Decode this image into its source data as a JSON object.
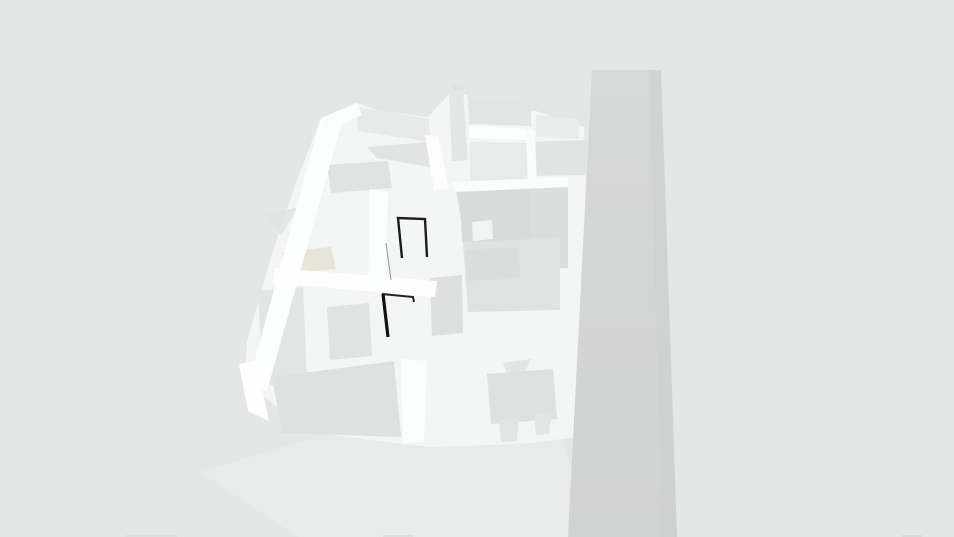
{
  "scene": {
    "background": "#e5e6e6",
    "accent_colors": {
      "model_white": "#fcfdfd",
      "floor_gray": "#dcdddd",
      "tower_gray": "#d4d5d5",
      "door_frame_black": "#1c1c1c",
      "beige_accent": "#e9e4d8"
    },
    "tower_gradient": {
      "top": "#d7d8d8",
      "bottom": "#d1d2d2"
    },
    "shapes": [
      {
        "name": "ground-shadow-wash",
        "type": "polygon",
        "points": "200,472 332,432 562,436 590,537 298,537",
        "fill": "#ececec",
        "opacity": 0.55,
        "interactable": false
      },
      {
        "name": "floorplan-base",
        "type": "polygon",
        "points": "321,118 357,103 380,111 428,117 451,92 467,95 471,113 536,111 584,127 586,182 584,260 580,340 578,437 521,444 430,447 401,444 309,432 262,395 244,392 247,342 271,257 297,180",
        "fill": "#f4f5f5",
        "opacity": 1,
        "interactable": false
      },
      {
        "name": "roof-panel",
        "type": "polygon",
        "points": "356,107 429,119 430,142 358,131",
        "fill": "#e8e9e9",
        "opacity": 1,
        "interactable": false
      },
      {
        "name": "gable-shadow",
        "type": "polygon",
        "points": "367,147 428,142 430,167 377,158",
        "fill": "#e2e3e3",
        "opacity": 1,
        "interactable": false
      },
      {
        "name": "sofa-block",
        "type": "polygon",
        "points": "327,165 388,161 392,188 331,193",
        "fill": "#e1e2e2",
        "opacity": 1,
        "interactable": true
      },
      {
        "name": "column-cap",
        "type": "polygon",
        "points": "452,85 463,84 464,95 453,96",
        "fill": "#e0e1e1",
        "opacity": 1,
        "interactable": false
      },
      {
        "name": "column-shaft",
        "type": "polygon",
        "points": "449,91 463,90 468,160 452,161",
        "fill": "#e5e6e6",
        "opacity": 1,
        "interactable": false
      },
      {
        "name": "room-floor-top-right-upper",
        "type": "polygon",
        "points": "468,99 531,103 531,126 469,124",
        "fill": "#e3e4e4",
        "opacity": 1,
        "interactable": false
      },
      {
        "name": "room-floor-top-far-right",
        "type": "polygon",
        "points": "536,115 578,119 579,139 536,137",
        "fill": "#eaebeb",
        "opacity": 1,
        "interactable": false
      },
      {
        "name": "room-floor-top-right-mid",
        "type": "polygon",
        "points": "470,142 528,143 528,188 470,188",
        "fill": "#e9eaea",
        "opacity": 1,
        "interactable": false
      },
      {
        "name": "room-floor-top-right-lower",
        "type": "polygon",
        "points": "530,142 586,140 586,175 530,176",
        "fill": "#e2e3e3",
        "opacity": 1,
        "interactable": false
      },
      {
        "name": "big-room-floor",
        "type": "polygon",
        "points": "456,190 568,184 568,268 470,273",
        "fill": "#dcdddd",
        "opacity": 1,
        "interactable": false
      },
      {
        "name": "big-room-rug",
        "type": "polygon",
        "points": "460,188 530,186 531,240 462,242",
        "fill": "#d9dada",
        "opacity": 1,
        "interactable": false
      },
      {
        "name": "big-room-white-table",
        "type": "polygon",
        "points": "472,222 492,220 493,239 473,241",
        "fill": "#f2f3f3",
        "opacity": 1,
        "interactable": true
      },
      {
        "name": "mid-room-floor",
        "type": "polygon",
        "points": "463,242 560,238 560,310 468,312",
        "fill": "#e0e1e1",
        "opacity": 1,
        "interactable": false
      },
      {
        "name": "mid-room-furniture-patch",
        "type": "polygon",
        "points": "465,250 518,247 520,278 467,281",
        "fill": "#dcdddd",
        "opacity": 1,
        "interactable": true
      },
      {
        "name": "cabinet-block",
        "type": "polygon",
        "points": "430,278 462,275 463,333 432,336",
        "fill": "#dedfdf",
        "opacity": 1,
        "interactable": true
      },
      {
        "name": "beige-counter-accent",
        "type": "polygon",
        "points": "282,252 331,247 336,269 287,274",
        "fill": "#e9e4d8",
        "opacity": 1,
        "interactable": true
      },
      {
        "name": "left-arrow-shape",
        "type": "polygon",
        "points": "266,214 298,207 281,236",
        "fill": "#e2e3e3",
        "opacity": 0.85,
        "interactable": false
      },
      {
        "name": "wardrobe-block",
        "type": "polygon",
        "points": "258,291 303,287 307,382 263,386",
        "fill": "#e3e4e4",
        "opacity": 1,
        "interactable": true
      },
      {
        "name": "nightstand-block",
        "type": "polygon",
        "points": "327,307 369,303 372,356 330,360",
        "fill": "#e1e2e2",
        "opacity": 1,
        "interactable": true
      },
      {
        "name": "bed-block",
        "type": "polygon",
        "points": "272,377 394,361 401,437 282,433",
        "fill": "#dfe0e0",
        "opacity": 1,
        "interactable": true
      },
      {
        "name": "dining-chair-top",
        "type": "polygon",
        "points": "503,363 531,359 523,376 508,377",
        "fill": "#e3e4e4",
        "opacity": 1,
        "interactable": true
      },
      {
        "name": "dining-table",
        "type": "polygon",
        "points": "487,374 553,369 557,419 491,424",
        "fill": "#dfe0e0",
        "opacity": 1,
        "interactable": true
      },
      {
        "name": "dining-chair-left",
        "type": "polygon",
        "points": "499,420 519,418 517,441 501,442",
        "fill": "#e3e4e4",
        "opacity": 1,
        "interactable": true
      },
      {
        "name": "dining-chair-right",
        "type": "polygon",
        "points": "534,414 551,412 549,434 536,435",
        "fill": "#e3e4e4",
        "opacity": 1,
        "interactable": true
      },
      {
        "name": "wall-outer-left",
        "type": "polygon",
        "points": "321,118 341,125 267,391 248,385",
        "fill": "#fdfefe",
        "opacity": 1,
        "interactable": false
      },
      {
        "name": "wall-top",
        "type": "polygon",
        "points": "321,118 357,103 362,115 329,131",
        "fill": "#fbfcfc",
        "opacity": 1,
        "interactable": false
      },
      {
        "name": "wall-mid-horizontal",
        "type": "polygon",
        "points": "275,268 437,281 435,297 273,283",
        "fill": "#fefefe",
        "opacity": 1,
        "interactable": false
      },
      {
        "name": "wall-mid-vertical",
        "type": "polygon",
        "points": "370,189 388,192 386,288 368,285",
        "fill": "#fcfdfd",
        "opacity": 1,
        "interactable": false
      },
      {
        "name": "wall-top-right-band",
        "type": "polygon",
        "points": "469,126 532,129 532,140 469,138",
        "fill": "#fdfefe",
        "opacity": 1,
        "interactable": false
      },
      {
        "name": "wall-top-right-vertical",
        "type": "polygon",
        "points": "526,130 535,131 537,188 528,188",
        "fill": "#fafbfb",
        "opacity": 1,
        "interactable": false
      },
      {
        "name": "wall-right-band",
        "type": "polygon",
        "points": "452,182 568,177 568,187 455,192",
        "fill": "#fbfcfc",
        "opacity": 1,
        "interactable": false
      },
      {
        "name": "wall-upper-left-vertical",
        "type": "polygon",
        "points": "425,135 438,137 449,189 434,190",
        "fill": "#fdfdfd",
        "opacity": 1,
        "interactable": false
      },
      {
        "name": "wall-bottom-left-wedge",
        "type": "polygon",
        "points": "239,364 256,361 269,421 248,411",
        "fill": "#fefefe",
        "opacity": 1,
        "interactable": false
      },
      {
        "name": "wall-mid-bottom",
        "type": "polygon",
        "points": "401,359 427,361 424,442 403,443",
        "fill": "#fcfdfd",
        "opacity": 1,
        "interactable": false
      },
      {
        "name": "wall-right-bottom",
        "type": "polygon",
        "points": "556,345 569,342 570,437 558,438",
        "fill": "#f4f5f5",
        "opacity": 1,
        "interactable": false
      },
      {
        "name": "door-edge-sliver",
        "type": "path",
        "d": "M386,243 L391,280",
        "stroke": "#555555",
        "strokeWidth": 1,
        "opacity": 0.6,
        "interactable": false
      },
      {
        "name": "door-frame-upper",
        "type": "path",
        "d": "M402,258 L398,218 L425,219 L427,257",
        "stroke": "#1c1c1c",
        "strokeWidth": 2.4,
        "opacity": 1,
        "interactable": true
      },
      {
        "name": "door-frame-lower-top",
        "type": "path",
        "d": "M382,294 L413,297 L414,302",
        "stroke": "#222222",
        "strokeWidth": 2,
        "opacity": 1,
        "interactable": true
      },
      {
        "name": "door-frame-lower-jamb",
        "type": "path",
        "d": "M383,294 L388,337",
        "stroke": "#111111",
        "strokeWidth": 3.2,
        "opacity": 1,
        "interactable": true
      },
      {
        "name": "tower-body",
        "type": "polygon",
        "points": "592,70 661,70 677,537 568,537",
        "fill": "url(#towerGrad)",
        "opacity": 1,
        "interactable": false
      },
      {
        "name": "tower-right-shade",
        "type": "polygon",
        "points": "649,70 661,70 677,537 662,537",
        "fill": "#cecfcf",
        "opacity": 0.55,
        "interactable": false
      },
      {
        "name": "bottom-edge-mark-1",
        "type": "rect",
        "x": 125,
        "y": 535,
        "w": 52,
        "h": 2,
        "fill": "#dddede",
        "opacity": 1,
        "interactable": false
      },
      {
        "name": "bottom-edge-mark-2",
        "type": "rect",
        "x": 383,
        "y": 535,
        "w": 30,
        "h": 2,
        "fill": "#dddede",
        "opacity": 1,
        "interactable": false
      },
      {
        "name": "bottom-edge-mark-3",
        "type": "rect",
        "x": 902,
        "y": 535,
        "w": 20,
        "h": 2,
        "fill": "#d9dada",
        "opacity": 1,
        "interactable": false
      }
    ]
  }
}
